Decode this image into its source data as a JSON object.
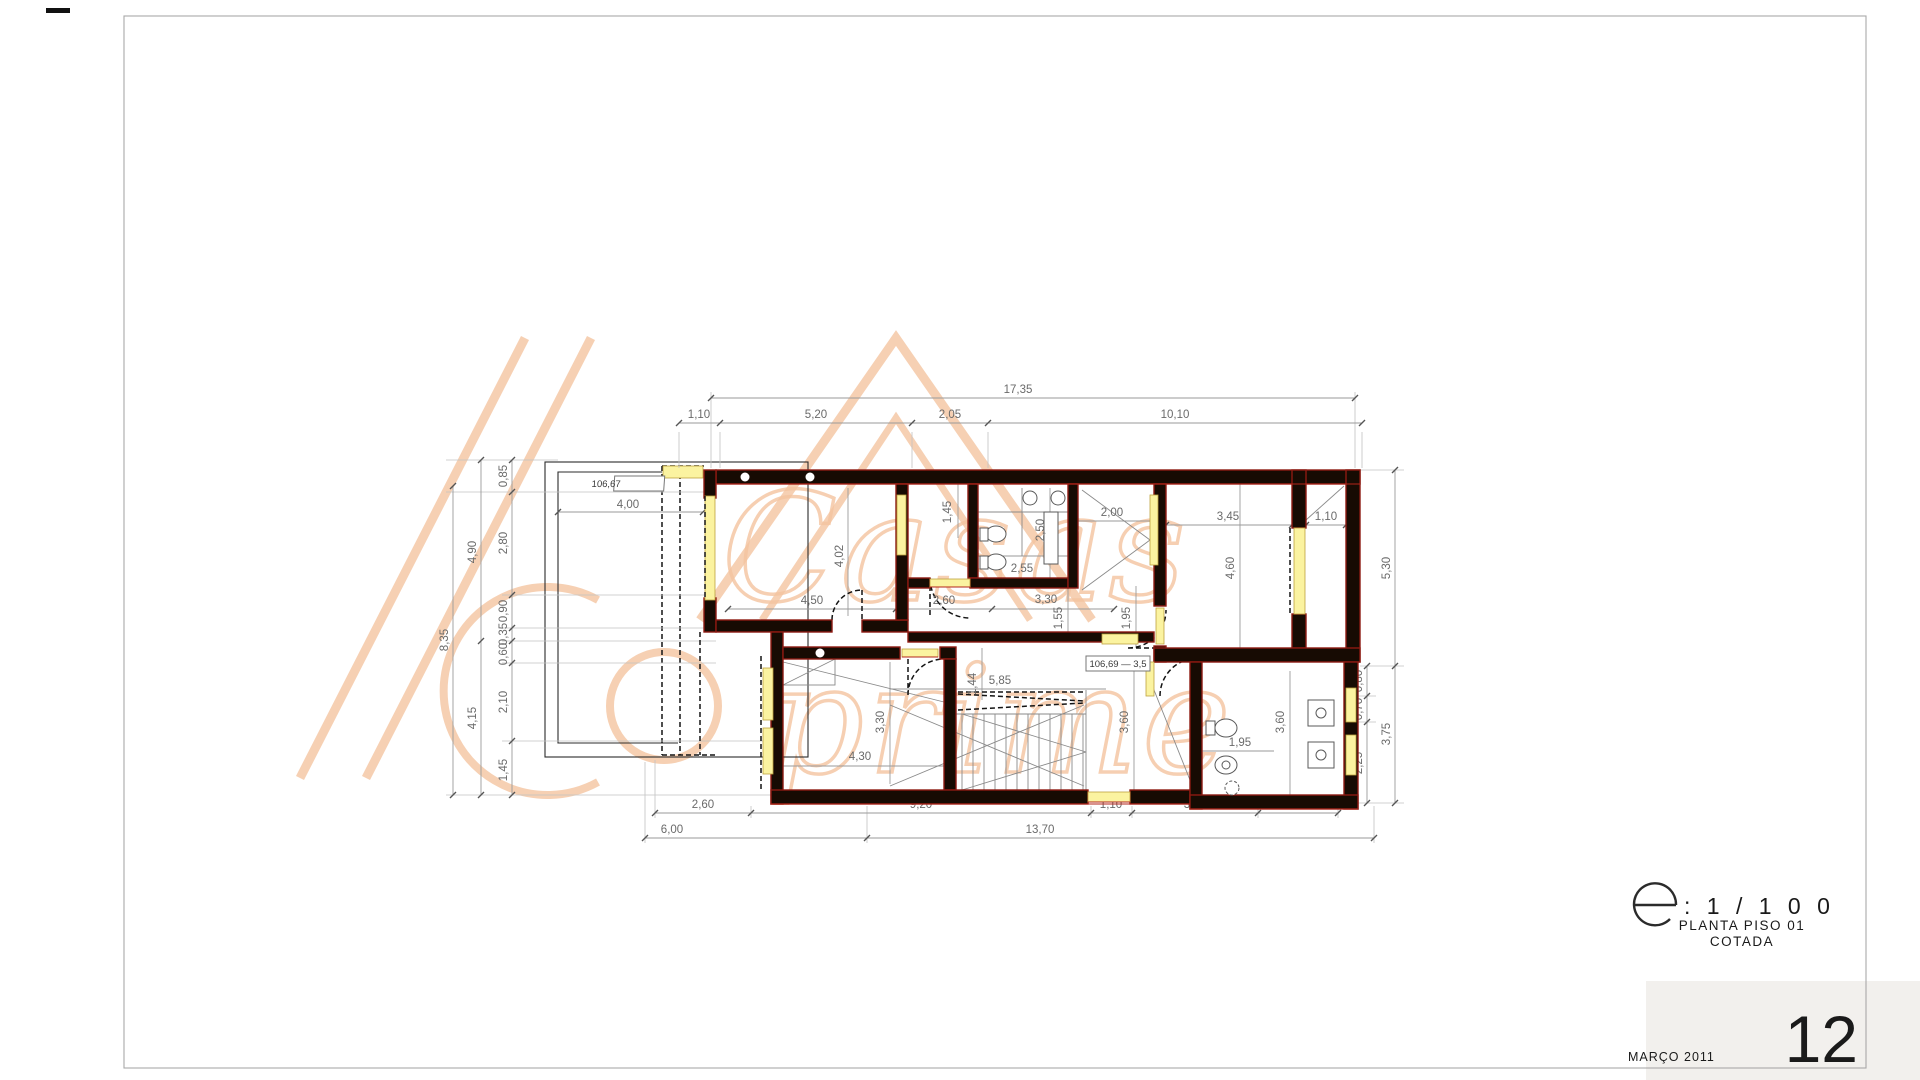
{
  "sheet": {
    "scale_letter": "e",
    "scale_value": ": 1 / 1 0 0",
    "title_line1": "PLANTA PISO 01",
    "title_line2": "COTADA",
    "date": "MARÇO 2011",
    "page_number": "12"
  },
  "watermark": {
    "word1": "Casas",
    "word2": "prime"
  },
  "levels": {
    "upper": "106,67",
    "lower": "106,69 — 3,5"
  },
  "dims": {
    "top_overall": "17,35",
    "top_chain": [
      "1,10",
      "5,20",
      "2,05",
      "10,10"
    ],
    "left_outer": "8,35",
    "left_mid": [
      "4,90",
      "4,15"
    ],
    "left_inner": [
      "0,85",
      "2,80",
      "0,90",
      "0,35",
      "0,60",
      "2,10",
      "1,45"
    ],
    "right_outer": [
      "5,30",
      "3,75"
    ],
    "right_inner": [
      "0,80",
      "0,70",
      "2,25"
    ],
    "bottom_inner": [
      "2,60",
      "9,20",
      "1,10",
      "3,40",
      "2,15"
    ],
    "bottom_outer": [
      "6,00",
      "13,70"
    ],
    "interior": {
      "annex_width": "4,00",
      "hall_depth": "1,45",
      "living_depth": "4,02",
      "bath1_depth": "2,50",
      "bath1_width": "2,55",
      "closet_width": "2,00",
      "bedroom2_width": "3,45",
      "shaft_width": "1,10",
      "bedroom2_depth": "4,60",
      "corridor_seg1": "4,50",
      "corridor_seg2": "2,60",
      "corridor_seg3": "3,30",
      "corridor_width": "1,55",
      "hall2_width": "1,95",
      "hall_lower_length": "5,85",
      "stair_width": "1,44",
      "bedroom3_width": "4,30",
      "bedroom3_depth": "3,30",
      "closet2_depth": "3,60",
      "bath2_depth": "3,60",
      "bath2_width": "1,95"
    }
  }
}
